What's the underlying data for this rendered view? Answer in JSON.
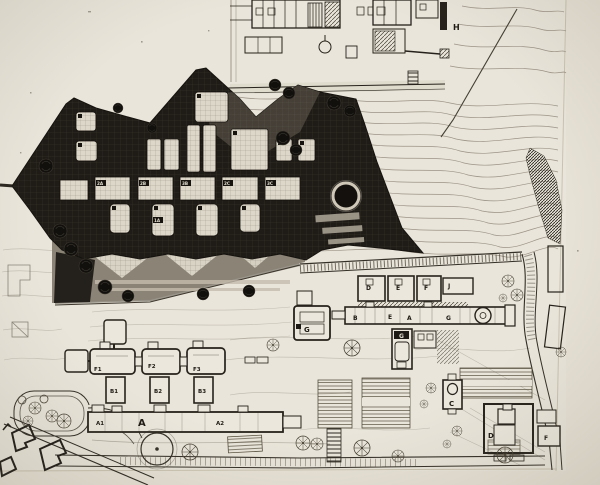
{
  "document": {
    "type": "scanned architectural site plan photograph",
    "description": "black-and-white master plan: dark building complex collaged over a contour-lined campus site plan"
  },
  "colors": {
    "paper": "#e9e5da",
    "margin": "#e7e2d6",
    "ink": "#2b2620",
    "faint_contour": "#9b9285",
    "dark_overlay": "#1f1b16",
    "gray_court": "#8a8376",
    "room_fill": "#ddd7c9"
  },
  "labels": {
    "h": "H",
    "def_row": [
      "D",
      "E",
      "F",
      "J"
    ],
    "bar": [
      "B",
      "E",
      "A",
      "G"
    ],
    "g_square": "G",
    "g_vertical": "G",
    "f_units": [
      "F1",
      "F2",
      "F3"
    ],
    "b_units": [
      "B1",
      "B2",
      "B3"
    ],
    "a_units": [
      "A1",
      "A",
      "A2"
    ],
    "c": "C",
    "d": "D",
    "f": "F",
    "dark_units": [
      "2A",
      "2B",
      "3B",
      "2C",
      "3C",
      "1A"
    ]
  }
}
